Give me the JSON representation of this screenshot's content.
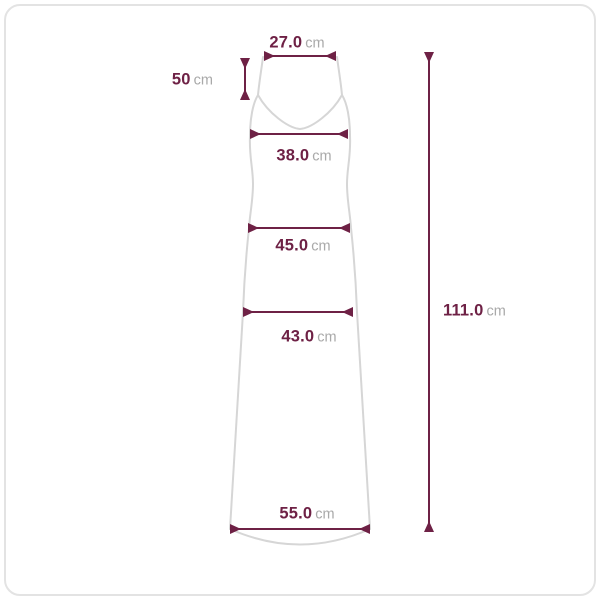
{
  "measurements": {
    "top_width": {
      "value": "27.0",
      "unit": "cm"
    },
    "strap_length": {
      "value": "50",
      "unit": "cm"
    },
    "bust_width": {
      "value": "38.0",
      "unit": "cm"
    },
    "waist_width": {
      "value": "45.0",
      "unit": "cm"
    },
    "hip_width": {
      "value": "43.0",
      "unit": "cm"
    },
    "hem_width": {
      "value": "55.0",
      "unit": "cm"
    },
    "total_length": {
      "value": "111.0",
      "unit": "cm"
    }
  },
  "colors": {
    "measurement_accent": "#6e2145",
    "unit_text": "#a9a9a9",
    "garment_outline": "#d6d6d6",
    "frame_border": "#e3e3e3",
    "background": "#ffffff"
  }
}
